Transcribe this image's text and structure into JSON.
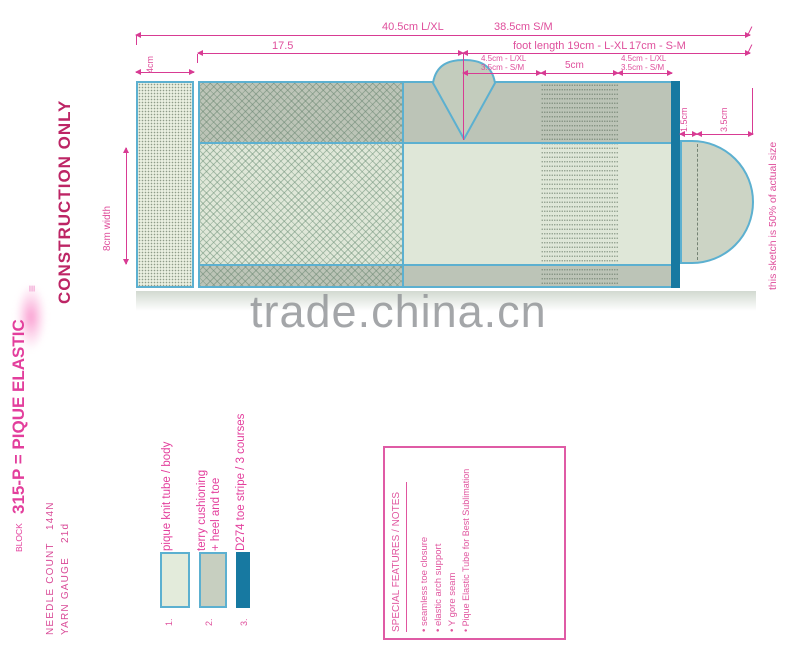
{
  "colors": {
    "accent_pink": "#d83b93",
    "deep_pink": "#bd2565",
    "magenta": "#e33e9c",
    "teal_border": "#5cb0d0",
    "toe_stripe_teal": "#1779a1",
    "body_light": "#dfe7d8",
    "band_shade": "#bbc4b6",
    "watermark_gray": "#8e9194"
  },
  "left_panel": {
    "construction_label": "CONSTRUCTION ONLY",
    "triple_bar_glyph": "≡",
    "block_label": "BLOCK",
    "block_value": "315-P = PIQUE ELASTIC",
    "needle_count_label": "NEEDLE COUNT",
    "needle_count_value": "144N",
    "yarn_gauge_label": "YARN GAUGE",
    "yarn_gauge_value": "21d"
  },
  "diagram": {
    "dim_total_lxl": "40.5cm L/XL",
    "dim_total_sm": "38.5cm S/M",
    "dim_leg": "17.5",
    "dim_foot_lxl": "foot length 19cm - L-XL",
    "dim_foot_sm": "17cm - S-M",
    "dim_heel_lxl": "4.5cm - L/XL",
    "dim_heel_sm": "3.5cm - S/M",
    "dim_arch": "5cm",
    "dim_toe_lxl": "4.5cm - L/XL",
    "dim_toe_sm": "3.5cm - S/M",
    "dim_cuff": "4cm",
    "dim_width": "8cm width",
    "dim_toe_stripe": "1.5cm",
    "dim_toe_len": "3.5cm",
    "scale_note": "this sketch is 50% of actual size"
  },
  "watermark": "trade.china.cn",
  "legend": {
    "items": [
      {
        "num": "1.",
        "label": "pique knit tube / body",
        "label2": ""
      },
      {
        "num": "2.",
        "label": "terry cushioning",
        "label2": "+ heel and toe"
      },
      {
        "num": "3.",
        "label": "D274 toe stripe / 3 courses",
        "label2": ""
      }
    ]
  },
  "notes_box": {
    "title": "SPECIAL FEATURES / NOTES",
    "items": [
      "• seamless toe closure",
      "• elastic arch support",
      "• Y gore seam",
      "• Pique Elastic Tube for Best Sublimation"
    ]
  }
}
